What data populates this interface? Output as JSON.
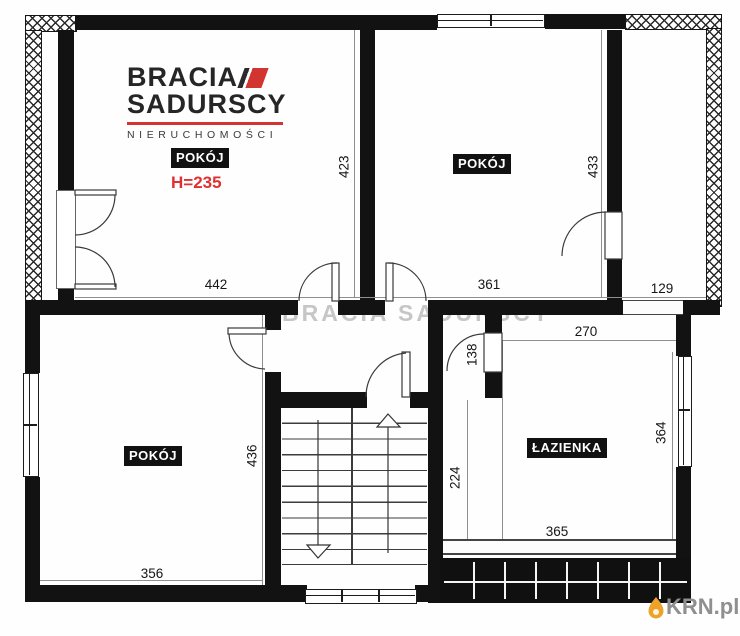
{
  "branding": {
    "agency_line1": "BRACIA",
    "agency_line2": "SADURSCY",
    "agency_line3": "NIERUCHOMOŚCI",
    "watermark": "BRACIA SADURSCY",
    "portal": "KRN.pl"
  },
  "rooms": {
    "top_left": {
      "name": "POKÓJ",
      "ceiling_height": "H=235",
      "width_cm": "442",
      "depth_cm": "423"
    },
    "top_middle": {
      "name": "POKÓJ",
      "width_cm": "361",
      "depth_cm": "433"
    },
    "bottom_left": {
      "name": "POKÓJ",
      "width_cm": "356",
      "depth_cm": "436"
    },
    "bathroom": {
      "name": "ŁAZIENKA",
      "top_cm": "270",
      "right_cm": "364",
      "bottom_cm": "365"
    },
    "balcony_right": {
      "width_cm": "129"
    },
    "hall": {
      "door_cm": "138",
      "corridor_cm": "224"
    }
  },
  "colors": {
    "wall": "#121212",
    "accent_red": "#d23430",
    "flame_orange": "#eda32a",
    "watermark_gray": "#c6c6c6"
  }
}
